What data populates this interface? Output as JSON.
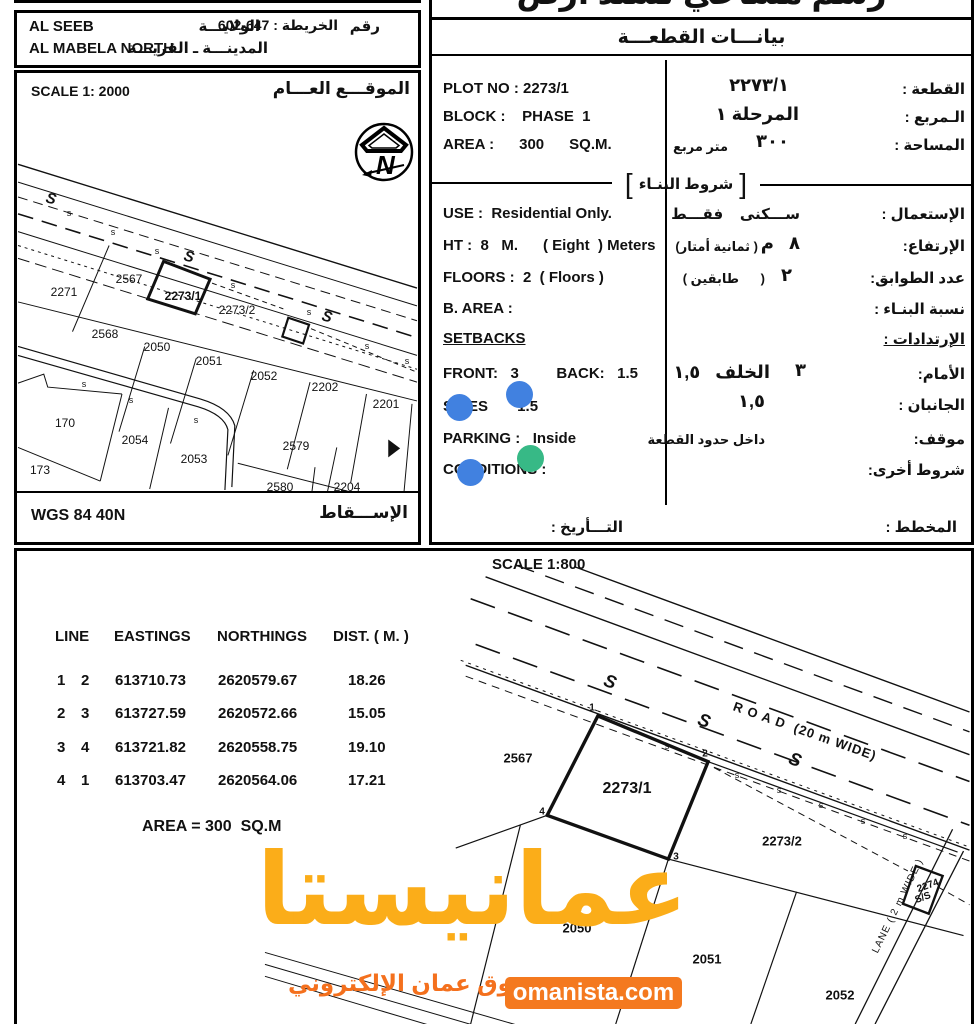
{
  "title_cut": "رسم مساحي لسند أرض",
  "left_panel": {
    "wilaya_en": "AL SEEB",
    "village_en": "AL MABELA NORTH",
    "wilaya_ar": "الولايـــة",
    "village_ar": "المدينـــة ـ القريـــة",
    "map_no_word": "رقم",
    "map_no_rest": "الخريطة : 647-602",
    "scale": "SCALE 1: 2000",
    "site_label_ar": "الموقـــع العـــام",
    "projection_en": "WGS 84 40N",
    "projection_ar": "الإســـقاط"
  },
  "plot_data": {
    "header_ar": "بيانـــات القطعـــة",
    "bracket_label_ar": "شروط البنـاء",
    "bracket_open": "[",
    "bracket_close": "]",
    "rows_en": [
      {
        "t": "PLOT NO : 2273/1",
        "x": 8,
        "y": 80
      },
      {
        "t": "BLOCK :    PHASE  1",
        "x": 8,
        "y": 108
      },
      {
        "t": "AREA :      300      SQ.M.",
        "x": 8,
        "y": 136
      },
      {
        "t": "USE :  Residential Only.",
        "x": 8,
        "y": 205
      },
      {
        "t": "HT :  8   M.      ( Eight  ) Meters",
        "x": 8,
        "y": 237
      },
      {
        "t": "FLOORS :  2  ( Floors )",
        "x": 8,
        "y": 269
      },
      {
        "t": "B. AREA :",
        "x": 8,
        "y": 300
      },
      {
        "t": "SETBACKS",
        "x": 8,
        "y": 330,
        "cls": "u"
      },
      {
        "t": "FRONT:   3         BACK:   1.5",
        "x": 8,
        "y": 365
      },
      {
        "t": "SIDES       1.5",
        "x": 8,
        "y": 398
      },
      {
        "t": "PARKING :   Inside",
        "x": 8,
        "y": 430
      },
      {
        "t": "CONDITIONS :",
        "x": 8,
        "y": 461
      }
    ],
    "rows_ar": [
      {
        "t": "القطعة :",
        "r": 6,
        "y": 80
      },
      {
        "t": "٢٢٧٣/١",
        "r": 182,
        "y": 75,
        "cls": "hn"
      },
      {
        "t": "الـمربع :",
        "r": 6,
        "y": 108
      },
      {
        "t": "المرحلة ١",
        "r": 172,
        "y": 104,
        "cls": "hn"
      },
      {
        "t": "المساحة :",
        "r": 6,
        "y": 136
      },
      {
        "t": "٣٠٠",
        "r": 182,
        "y": 131,
        "cls": "hn"
      },
      {
        "t": "متر مربع",
        "r": 243,
        "y": 139,
        "cls": "sm"
      },
      {
        "t": "الإستعمال :",
        "r": 6,
        "y": 205
      },
      {
        "t": "ســـكنى    فقـــط",
        "r": 171,
        "y": 205
      },
      {
        "t": "الإرتفاع:",
        "r": 6,
        "y": 237
      },
      {
        "t": "٨   م",
        "r": 171,
        "y": 233,
        "cls": "hn"
      },
      {
        "t": "( ثمانية أمتار)",
        "r": 213,
        "y": 239,
        "cls": "sm"
      },
      {
        "t": "عدد الطوابق:",
        "r": 6,
        "y": 269
      },
      {
        "t": "٢",
        "r": 179,
        "y": 265,
        "cls": "hn"
      },
      {
        "t": "(      طابقين )",
        "r": 206,
        "y": 271,
        "cls": "sm"
      },
      {
        "t": "نسبة البنـاء :",
        "r": 6,
        "y": 300
      },
      {
        "t": "الإرتدادات :",
        "r": 6,
        "y": 330,
        "cls": "u"
      },
      {
        "t": "الأمام:",
        "r": 6,
        "y": 365
      },
      {
        "t": "٣",
        "r": 165,
        "y": 360,
        "cls": "hn"
      },
      {
        "t": "الخلف   ١,٥",
        "r": 201,
        "y": 362,
        "cls": "hn"
      },
      {
        "t": "الجانبان :",
        "r": 6,
        "y": 396
      },
      {
        "t": "١,٥",
        "r": 206,
        "y": 391,
        "cls": "hn"
      },
      {
        "t": "موقف:",
        "r": 6,
        "y": 430
      },
      {
        "t": "داخل حدود القطعة",
        "r": 206,
        "y": 432,
        "cls": "sm"
      },
      {
        "t": "شروط أخرى:",
        "r": 6,
        "y": 461
      },
      {
        "t": "المخطط :",
        "r": 14,
        "y": 518
      },
      {
        "t": "التـــأريخ :",
        "r": 348,
        "y": 518
      }
    ]
  },
  "coords_table": {
    "headers": [
      "LINE",
      "EASTINGS",
      "NORTHINGS",
      "DIST. ( M. )"
    ],
    "header_x": [
      38,
      97,
      200,
      316
    ],
    "header_y": 77,
    "col_x": [
      40,
      64,
      98,
      201,
      331
    ],
    "row_y": [
      121,
      154,
      188,
      221
    ],
    "rows": [
      [
        "1",
        "2",
        "613710.73",
        "2620579.67",
        "18.26"
      ],
      [
        "2",
        "3",
        "613727.59",
        "2620572.66",
        "15.05"
      ],
      [
        "3",
        "4",
        "613721.82",
        "2620558.75",
        "19.10"
      ],
      [
        "4",
        "1",
        "613703.47",
        "2620564.06",
        "17.21"
      ]
    ],
    "area_note": "AREA = 300  SQ.M"
  },
  "overview_map": {
    "labels": [
      {
        "t": "2271",
        "x": 47,
        "y": 193
      },
      {
        "t": "2567",
        "x": 112,
        "y": 180
      },
      {
        "t": "2273/1",
        "x": 166,
        "y": 197,
        "cls": "b"
      },
      {
        "t": "2273/2",
        "x": 220,
        "y": 211
      },
      {
        "t": "2568",
        "x": 88,
        "y": 235
      },
      {
        "t": "2050",
        "x": 140,
        "y": 248
      },
      {
        "t": "2051",
        "x": 192,
        "y": 262
      },
      {
        "t": "2052",
        "x": 247,
        "y": 277
      },
      {
        "t": "2202",
        "x": 308,
        "y": 288
      },
      {
        "t": "2201",
        "x": 369,
        "y": 305
      },
      {
        "t": "170",
        "x": 48,
        "y": 324
      },
      {
        "t": "2054",
        "x": 118,
        "y": 341
      },
      {
        "t": "2053",
        "x": 177,
        "y": 360
      },
      {
        "t": "2579",
        "x": 279,
        "y": 347
      },
      {
        "t": "173",
        "x": 23,
        "y": 371
      },
      {
        "t": "2580",
        "x": 263,
        "y": 388
      },
      {
        "t": "2204",
        "x": 330,
        "y": 388
      },
      {
        "t": "S",
        "x": 34,
        "y": 100,
        "rot": 15,
        "cls": "sg"
      },
      {
        "t": "s",
        "x": 52,
        "y": 114,
        "cls": "ss"
      },
      {
        "t": "s",
        "x": 96,
        "y": 133,
        "cls": "ss"
      },
      {
        "t": "s",
        "x": 140,
        "y": 152,
        "cls": "ss"
      },
      {
        "t": "S",
        "x": 172,
        "y": 158,
        "rot": 15,
        "cls": "sg"
      },
      {
        "t": "s",
        "x": 216,
        "y": 186,
        "cls": "ss"
      },
      {
        "t": "s",
        "x": 292,
        "y": 213,
        "cls": "ss"
      },
      {
        "t": "S",
        "x": 310,
        "y": 218,
        "rot": 15,
        "cls": "sg"
      },
      {
        "t": "s",
        "x": 350,
        "y": 247,
        "cls": "ss"
      },
      {
        "t": "s",
        "x": 390,
        "y": 262,
        "cls": "ss"
      },
      {
        "t": "s",
        "x": 67,
        "y": 285,
        "cls": "ss"
      },
      {
        "t": "s",
        "x": 114,
        "y": 301,
        "cls": "ss"
      },
      {
        "t": "s",
        "x": 179,
        "y": 321,
        "cls": "ss"
      }
    ]
  },
  "detail_map": {
    "scale": "SCALE 1:800",
    "labels": [
      {
        "t": "2567",
        "x": 501,
        "y": 207
      },
      {
        "t": "2273/1",
        "x": 610,
        "y": 238,
        "cls": "b"
      },
      {
        "t": "2273/2",
        "x": 765,
        "y": 290
      },
      {
        "t": "2050",
        "x": 560,
        "y": 377
      },
      {
        "t": "2051",
        "x": 690,
        "y": 408
      },
      {
        "t": "2052",
        "x": 823,
        "y": 444
      },
      {
        "t": "2274",
        "x": 911,
        "y": 335,
        "rot": -20,
        "cls": "tiny"
      },
      {
        "t": "S/S",
        "x": 906,
        "y": 347,
        "rot": -20,
        "cls": "tiny"
      },
      {
        "t": "R O A D  (20 m WIDE)",
        "x": 788,
        "y": 180,
        "rot": 19.5,
        "cls": "road"
      },
      {
        "t": "LANE ( 2 m WIDE )",
        "x": 881,
        "y": 355,
        "rot": -64,
        "cls": "lane"
      },
      {
        "t": "S",
        "x": 593,
        "y": 131,
        "rot": 20,
        "cls": "sg2"
      },
      {
        "t": "S",
        "x": 687,
        "y": 170,
        "rot": 20,
        "cls": "sg2"
      },
      {
        "t": "S",
        "x": 778,
        "y": 209,
        "rot": 20,
        "cls": "sg2"
      },
      {
        "t": "s",
        "x": 650,
        "y": 195,
        "cls": "ss2"
      },
      {
        "t": "s",
        "x": 720,
        "y": 224,
        "cls": "ss2"
      },
      {
        "t": "s",
        "x": 762,
        "y": 239,
        "cls": "ss2"
      },
      {
        "t": "s",
        "x": 804,
        "y": 254,
        "cls": "ss2"
      },
      {
        "t": "s",
        "x": 846,
        "y": 270,
        "cls": "ss2"
      },
      {
        "t": "s",
        "x": 888,
        "y": 285,
        "cls": "ss2"
      }
    ],
    "corner_labels": [
      {
        "t": "1",
        "x": 575,
        "y": 157
      },
      {
        "t": "2",
        "x": 688,
        "y": 203
      },
      {
        "t": "3",
        "x": 659,
        "y": 306
      },
      {
        "t": "4",
        "x": 525,
        "y": 261
      }
    ]
  },
  "watermark": {
    "logo": "عمانيستا",
    "tagline": "سوق عمان الإلكتروني",
    "site": "omanista.com",
    "logo_color": "#FBAD19",
    "tag_color": "#F4701D",
    "box_color": "#F4791F"
  },
  "dots": [
    {
      "x": 519,
      "y": 394,
      "color": "#4181E0"
    },
    {
      "x": 459,
      "y": 407,
      "color": "#4181E0"
    },
    {
      "x": 530,
      "y": 458,
      "color": "#37B986"
    },
    {
      "x": 470,
      "y": 472,
      "color": "#4181E0"
    }
  ]
}
